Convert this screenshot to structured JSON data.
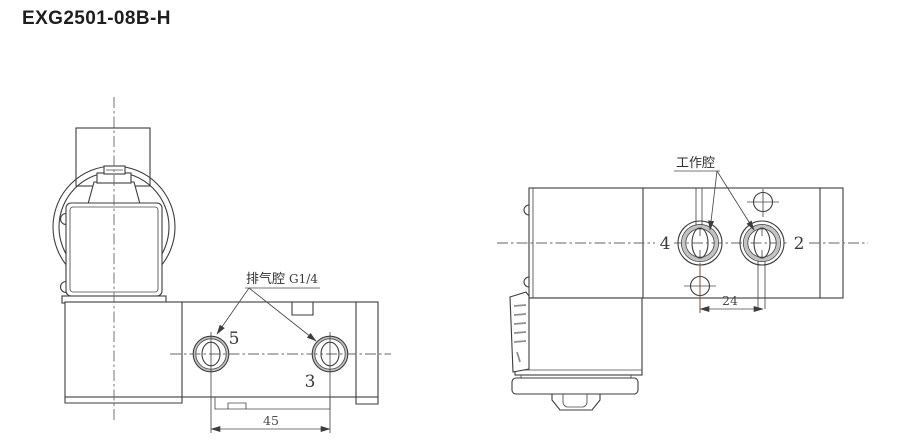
{
  "title": "EXG2501-08B-H",
  "left_view": {
    "port5": "5",
    "port3": "3",
    "annotation": "排气腔",
    "spec": "G1/4",
    "dim": "45"
  },
  "right_view": {
    "port4": "4",
    "port2": "2",
    "annotation": "工作腔",
    "dim": "24"
  },
  "colors": {
    "line": "#3d3d3d",
    "centerline": "#666666",
    "accent_extension_line": "#8b4a42",
    "port_ring": "#c2c2c2",
    "background": "#ffffff"
  }
}
